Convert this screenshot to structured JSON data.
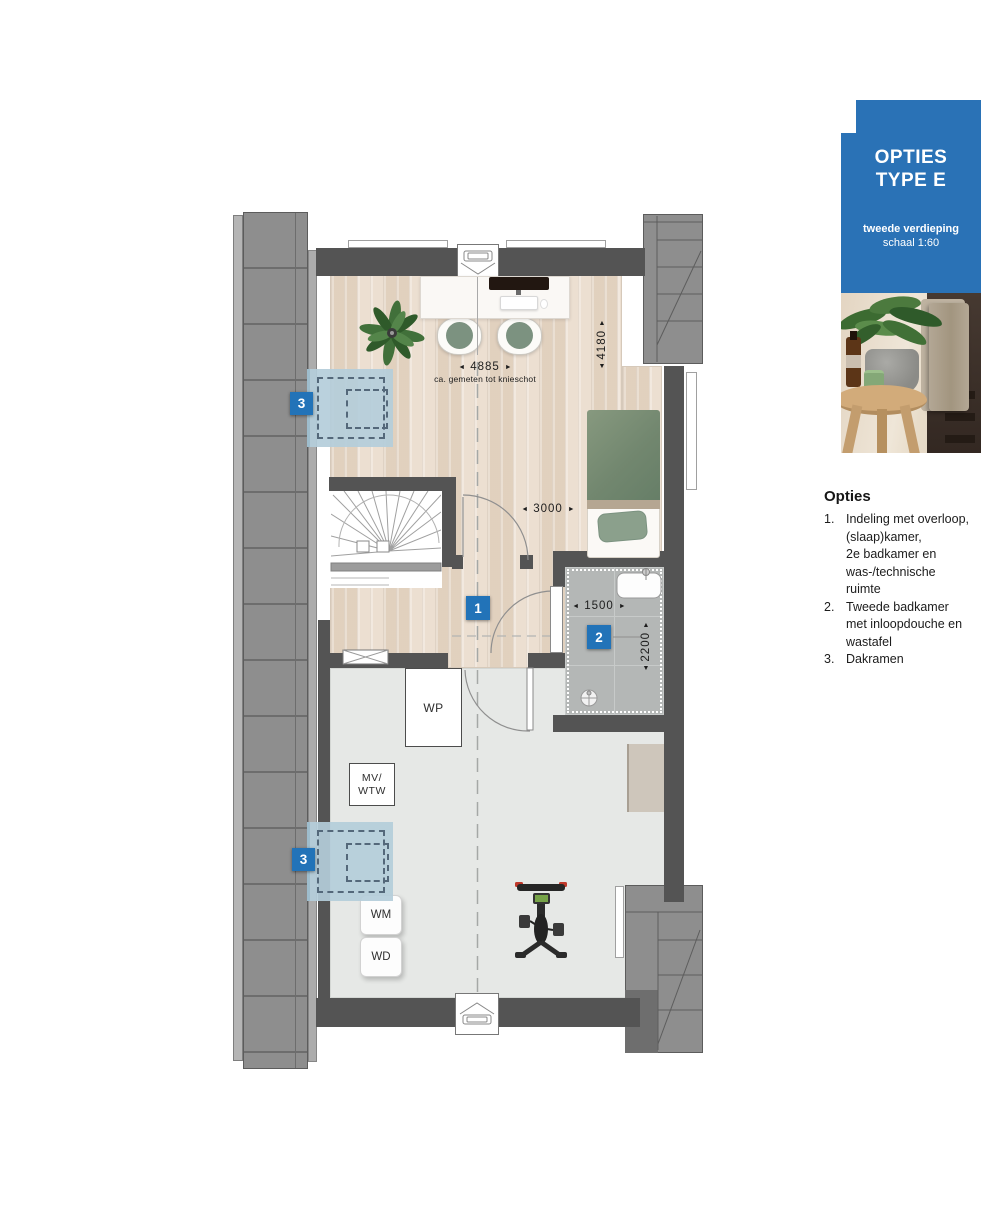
{
  "sidebar": {
    "badge": {
      "title_line1": "OPTIES",
      "title_line2": "TYPE E",
      "subtitle_line1": "tweede verdieping",
      "subtitle_line2": "schaal 1:60",
      "bg_color": "#2a72b6"
    },
    "options": {
      "heading": "Opties",
      "items": [
        {
          "num": "1.",
          "text": "Indeling met overloop,\n(slaap)kamer,\n2e badkamer en\nwas-/technische\nruimte"
        },
        {
          "num": "2.",
          "text": "Tweede badkamer\nmet inloopdouche en\nwastafel"
        },
        {
          "num": "3.",
          "text": "Dakramen"
        }
      ]
    }
  },
  "plan": {
    "markers": [
      {
        "id": "dakraam-top",
        "label": "3"
      },
      {
        "id": "overloop",
        "label": "1"
      },
      {
        "id": "tweede-badkamer",
        "label": "2"
      },
      {
        "id": "dakraam-bottom",
        "label": "3"
      }
    ],
    "room_labels": {
      "wp": "WP",
      "mv_line1": "MV/",
      "mv_line2": "WTW",
      "wm": "WM",
      "wd": "WD"
    },
    "dimensions": {
      "top_width": "4885",
      "top_width_note": "ca. gemeten tot knieschot",
      "right_height": "4180",
      "bed_width": "3000",
      "bath_width": "1500",
      "bath_depth": "2200"
    },
    "colors": {
      "marker_blue": "#2273b8",
      "wall": "#545454",
      "roof": "#8e8e8e",
      "dakraam_blue": "#b4cdda",
      "wood_floor": "#ecdfd1",
      "tech_floor": "#e6e8e6",
      "tile": "#b4b7b6"
    }
  },
  "icons": {
    "arrow_left": "◄",
    "arrow_right": "►",
    "arrow_up": "▲",
    "arrow_down": "▼"
  }
}
